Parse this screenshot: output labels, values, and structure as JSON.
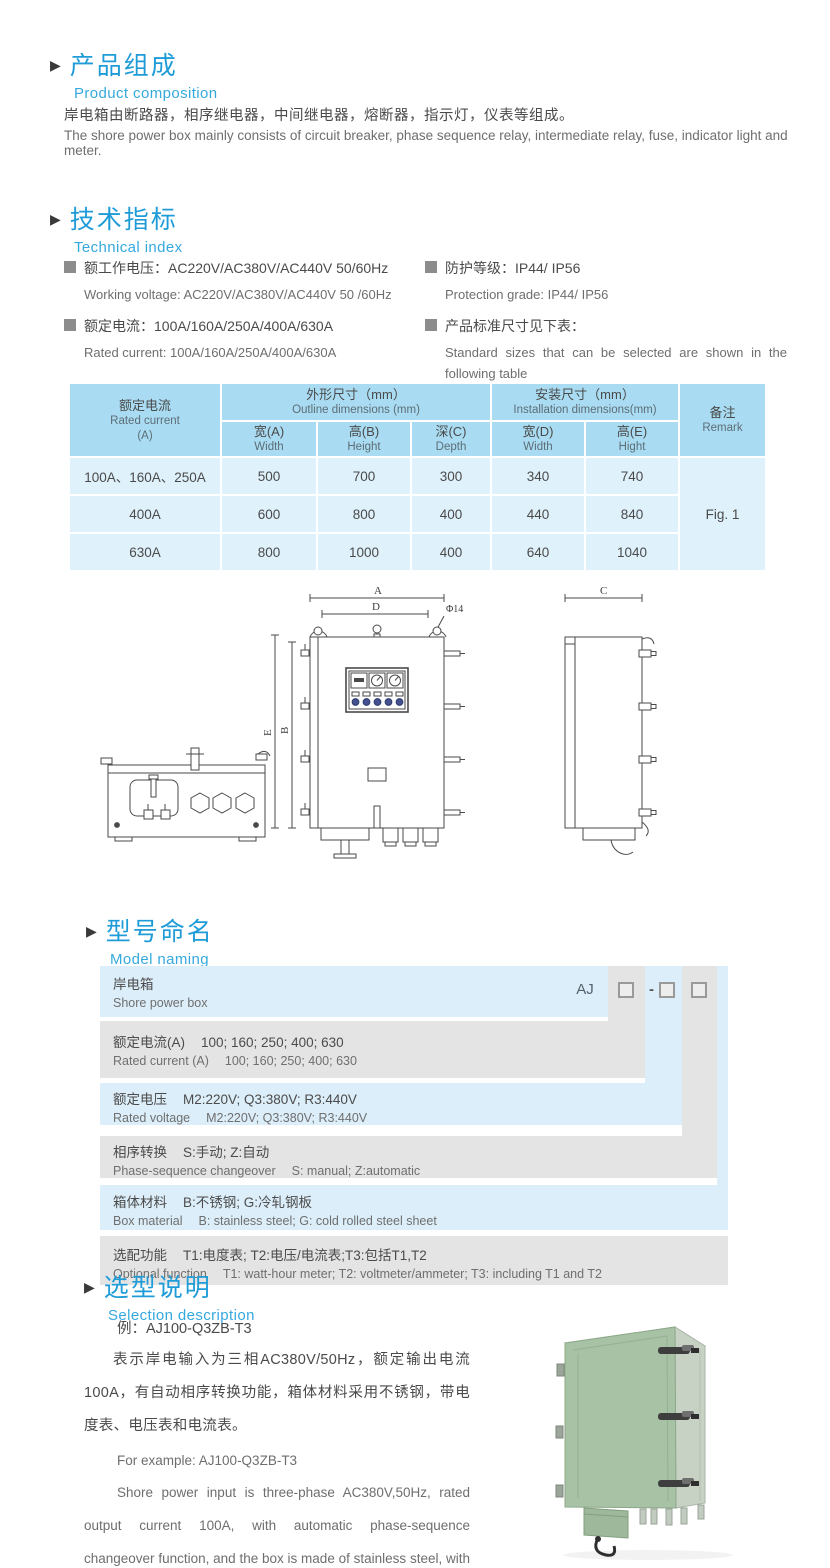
{
  "colors": {
    "accent": "#1F9CD8",
    "accent_light": "#35A9DE",
    "table_header_bg": "#A9DCF2",
    "table_body_bg": "#DFF1FB",
    "naming_blue": "#DCEEF9",
    "naming_gray": "#E4E4E4",
    "body_text": "#4A4A4A",
    "photo_door_green": "#A7C2A4"
  },
  "sections": {
    "product_composition": {
      "title_cn": "产品组成",
      "title_en": "Product  composition",
      "body_cn": "岸电箱由断路器，相序继电器，中间继电器，熔断器，指示灯，仪表等组成。",
      "body_en": "The shore power box mainly consists of circuit breaker, phase sequence relay, intermediate relay, fuse, indicator light and meter."
    },
    "technical_index": {
      "title_cn": "技术指标",
      "title_en": "Technical index",
      "specs_left": [
        {
          "cn": "额工作电压：AC220V/AC380V/AC440V  50/60Hz",
          "en": "Working voltage: AC220V/AC380V/AC440V 50 /60Hz"
        },
        {
          "cn": "额定电流：100A/160A/250A/400A/630A",
          "en": "Rated current: 100A/160A/250A/400A/630A"
        }
      ],
      "specs_right": [
        {
          "cn": "防护等级：IP44/ IP56",
          "en": "Protection grade: IP44/ IP56"
        },
        {
          "cn": "产品标准尺寸见下表：",
          "en": "Standard sizes that can be selected are shown in the following table"
        }
      ]
    }
  },
  "size_table": {
    "header": {
      "rated_cn": "额定电流",
      "rated_en": "Rated current",
      "rated_unit": "(A)",
      "outline_cn": "外形尺寸（mm）",
      "outline_en": "Outline dimensions (mm)",
      "install_cn": "安装尺寸（mm）",
      "install_en": "Installation dimensions(mm)",
      "remark_cn": "备注",
      "remark_en": "Remark",
      "cols": [
        {
          "cn": "宽(A)",
          "en": "Width"
        },
        {
          "cn": "高(B)",
          "en": "Height"
        },
        {
          "cn": "深(C)",
          "en": "Depth"
        },
        {
          "cn": "宽(D)",
          "en": "Width"
        },
        {
          "cn": "高(E)",
          "en": "Hight"
        }
      ]
    },
    "rows": [
      {
        "current": "100A、160A、250A",
        "values": [
          "500",
          "700",
          "300",
          "340",
          "740"
        ]
      },
      {
        "current": "400A",
        "values": [
          "600",
          "800",
          "400",
          "440",
          "840"
        ]
      },
      {
        "current": "630A",
        "values": [
          "800",
          "1000",
          "400",
          "640",
          "1040"
        ]
      }
    ],
    "remark": "Fig. 1"
  },
  "drawing": {
    "labels": {
      "A": "A",
      "D": "D",
      "dia": "Φ14",
      "E": "E",
      "B": "B",
      "C": "C"
    }
  },
  "model_naming": {
    "title_cn": "型号命名",
    "title_en": "Model naming",
    "code": {
      "prefix": "AJ",
      "separator": "-"
    },
    "rows": [
      {
        "cn_label": "岸电箱",
        "cn_desc": "",
        "en_label": "Shore power box",
        "en_desc": ""
      },
      {
        "cn_label": "额定电流(A)",
        "cn_desc": "100; 160; 250; 400; 630",
        "en_label": "Rated current (A)",
        "en_desc": "100; 160; 250; 400; 630"
      },
      {
        "cn_label": "额定电压",
        "cn_desc": "M2:220V;  Q3:380V;  R3:440V",
        "en_label": "Rated voltage",
        "en_desc": "M2:220V;  Q3:380V;  R3:440V"
      },
      {
        "cn_label": "相序转换",
        "cn_desc": "S:手动; Z:自动",
        "en_label": "Phase-sequence changeover",
        "en_desc": "S: manual;  Z:automatic"
      },
      {
        "cn_label": "箱体材料",
        "cn_desc": "B:不锈钢;  G:冷轧钢板",
        "en_label": "Box material",
        "en_desc": "B: stainless steel; G: cold rolled steel sheet"
      },
      {
        "cn_label": "选配功能",
        "cn_desc": "T1:电度表;  T2:电压/电流表;T3:包括T1,T2",
        "en_label": "Optional function",
        "en_desc": "T1: watt-hour meter; T2: voltmeter/ammeter; T3: including T1 and T2"
      }
    ]
  },
  "selection": {
    "title_cn": "选型说明",
    "title_en": "Selection description",
    "example_cn": "例：AJ100-Q3ZB-T3",
    "body_cn": "表示岸电输入为三相AC380V/50Hz，额定输出电流100A，有自动相序转换功能，箱体材料采用不锈钢，带电度表、电压表和电流表。",
    "example_en": "For example: AJ100-Q3ZB-T3",
    "body_en": "Shore power input is three-phase AC380V,50Hz, rated output current 100A, with automatic phase-sequence changeover function, and the box is made of stainless steel, with watt-hour meter, voltmeter and ammeter."
  }
}
